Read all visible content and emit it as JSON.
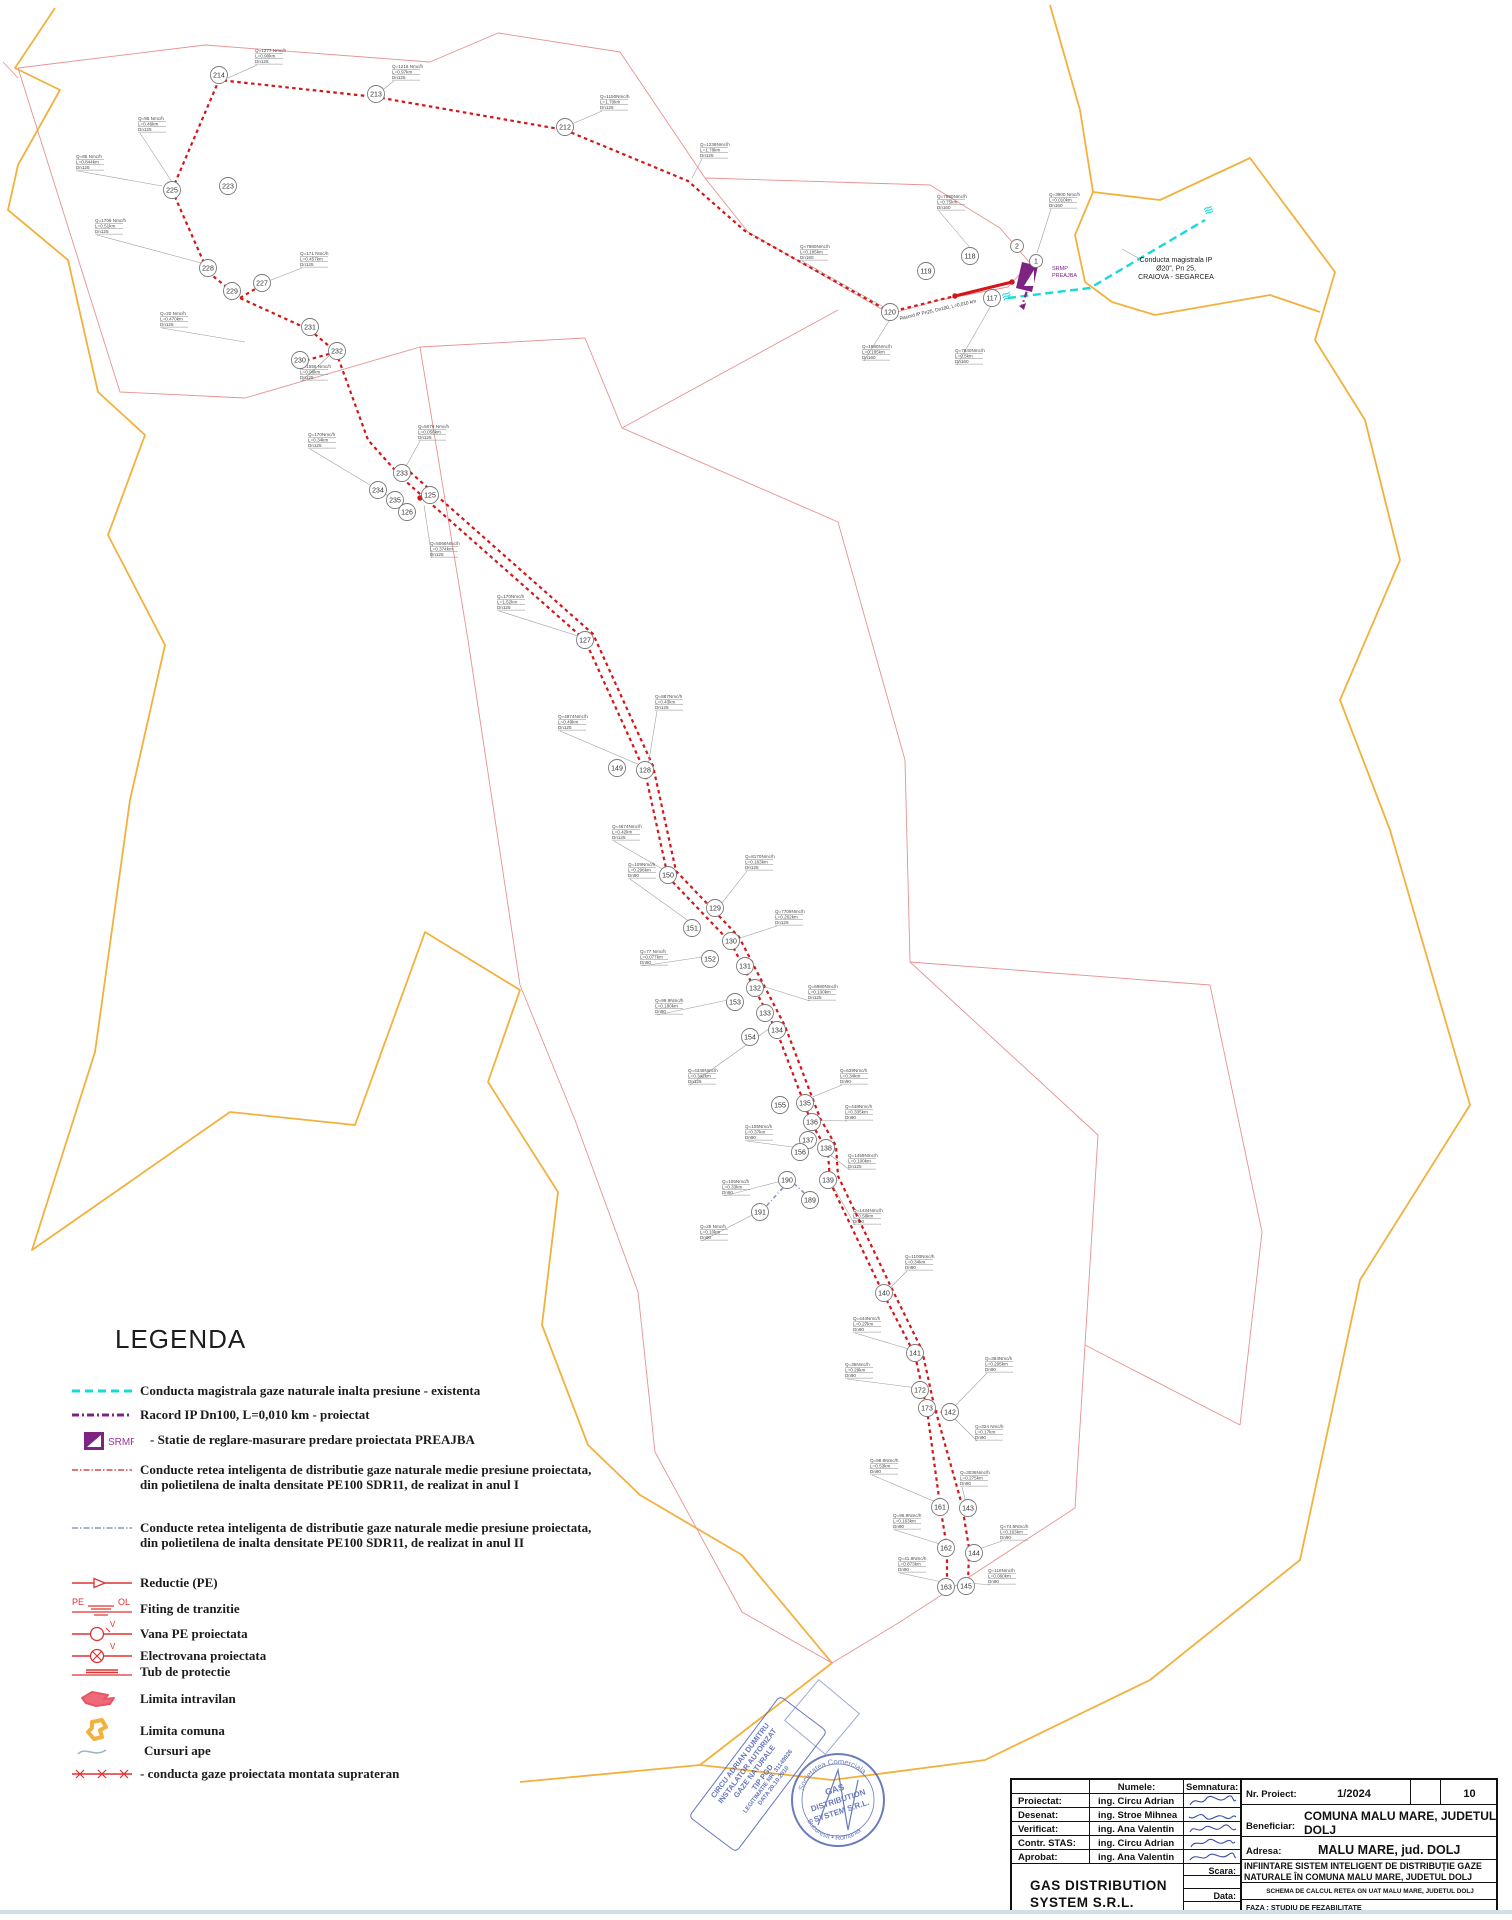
{
  "legend": {
    "title": "LEGENDA",
    "swatch_texts": {
      "srmp": "SRMP",
      "pe": "PE",
      "ol": "OL",
      "v1": "V",
      "v2": "V"
    },
    "items": [
      {
        "label": "Conducta  magistrala gaze naturale inalta presiune - existenta"
      },
      {
        "label": "Racord IP Dn100, L=0,010 km  - proiectat"
      },
      {
        "label": "- Statie de reglare-masurare predare proiectata PREAJBA"
      },
      {
        "label": "Conducte retea inteligenta de distributie gaze naturale medie presiune proiectata, din polietilena de inalta densitate PE100 SDR11, de realizat in anul I"
      },
      {
        "label": "Conducte retea inteligenta de distributie gaze naturale medie presiune proiectata, din polietilena de inalta densitate PE100 SDR11, de realizat in anul II"
      },
      {
        "label": "Reductie (PE)"
      },
      {
        "label": "Fiting de tranzitie"
      },
      {
        "label": "Vana PE proiectata"
      },
      {
        "label": "Electrovana  proiectata"
      },
      {
        "label": "Tub de protectie"
      },
      {
        "label": "Limita intravilan"
      },
      {
        "label": "Limita comuna"
      },
      {
        "label": "Cursuri ape"
      },
      {
        "label": "- conducta gaze proiectata montata suprateran"
      }
    ]
  },
  "title_block": {
    "numele_header": "Numele:",
    "semnatura_header": "Semnatura:",
    "rows": [
      {
        "label": "Proiectat:",
        "name": "ing. Circu Adrian"
      },
      {
        "label": "Desenat:",
        "name": "ing. Stroe Mihnea"
      },
      {
        "label": "Verificat:",
        "name": "ing. Ana Valentin"
      },
      {
        "label": "Contr. STAS:",
        "name": "ing. Circu Adrian"
      },
      {
        "label": "Aprobat:",
        "name": "ing. Ana Valentin"
      }
    ],
    "company": "GAS DISTRIBUTION SYSTEM S.R.L.",
    "scara_label": "Scara:",
    "data_label": "Data:",
    "nr_proiect_label": "Nr. Proiect:",
    "nr_proiect_value": "1/2024",
    "sheet_number": "10",
    "beneficiar_label": "Beneficiar:",
    "beneficiar_value": "COMUNA MALU MARE, JUDETUL DOLJ",
    "adresa_label": "Adresa:",
    "adresa_value": "MALU MARE, jud. DOLJ",
    "project_title": "INFIINTARE SISTEM INTELIGENT DE DISTRIBUŢIE  GAZE NATURALE ÎN COMUNA MALU MARE, JUDETUL DOLJ",
    "drawing_title": "SCHEMA DE CALCUL  RETEA GN  UAT MALU MARE, JUDETUL DOLJ",
    "faza": "FAZA :  STUDIU DE FEZABILITATE"
  },
  "stamps": {
    "rect": {
      "lines": [
        "CIRCU ADRIAN DUMITRU",
        "INSTALATOR AUTORIZAT",
        "GAZE NATURALE",
        "TIP PGD",
        "LEGITIMATIE NR. 31149926",
        "DATA 20.10.2010"
      ]
    },
    "round": {
      "top": "Societatea Comerciala",
      "mid1": "GAS",
      "mid2": "DISTRIBUTION",
      "mid3": "SYSTEM S.R.L.",
      "bottom": "Bucuresti • Romania"
    }
  },
  "map": {
    "boundary_comuna": [
      "55,8 15,68 60,90 18,165 8,210 68,260 98,392 145,435 108,535 165,645 130,800 95,1052 32,1250 230,1112 355,1125 425,932 520,990 488,1082 558,1192 542,1325 588,1445 640,1495 742,1555 832,1663 700,1765 520,1782",
      "1050,5 1080,110 1093,192 1160,200 1250,158 1335,272 1315,340 1365,420 1400,560 1340,700 1390,830 1470,1105 1360,1280 1300,1560 1150,1680 985,1760 832,1780 700,1765",
      "1093,192 1075,235 1085,282 1112,302 1155,315 1270,295 1320,312"
    ],
    "boundary_intravilan": [
      "18,68 205,45 430,62 498,33 620,52 705,178 748,232 890,314",
      "890,314 940,300 1008,287 1030,263 1000,228 930,185 705,178",
      "18,68 120,392 245,398 420,347 585,338",
      "622,428 838,310",
      "585,338 622,428 838,522 905,760 910,962 1098,1135 1085,1345 1075,1508 900,1622 832,1663 742,1612 655,1452 638,1292 575,1120 520,985 468,640 420,347",
      "910,962 1210,985 1262,1232 1240,1425 1085,1345",
      "3,62 18,78"
    ],
    "pipe_year1": [
      "172,190 219,80 376,97 565,130 688,181 745,231 890,312 955,296",
      "172,190 208,272 240,298 310,330 336,352 368,440 402,478",
      "240,298 262,285",
      "336,352 300,362",
      "402,478 585,640 645,772 668,877 731,943 777,1032 812,1124 828,1152 830,1182 884,1295 915,1355 927,1410 940,1505 947,1548 947,1587",
      "410,472 593,634 653,766 676,871 739,937 785,1026 820,1118 836,1146 838,1176 892,1289 922,1350 934,1405 962,1505 969,1548 968,1586",
      "927,1410 950,1413"
    ],
    "pipe_year1_solid": [
      "955,296 1012,282"
    ],
    "pipe_year2": [
      "760,1213 790,1180 812,1200"
    ],
    "pipe_main_existing": "1008,298 1090,288 1205,220",
    "pipe_racord": "1035,266 1022,306",
    "breaks": [
      [
        1205,
        216,
        -20
      ],
      [
        1003,
        302,
        -20
      ]
    ],
    "junctions": [
      [
        172,
        190
      ],
      [
        402,
        478
      ],
      [
        648,
        772
      ],
      [
        731,
        943
      ],
      [
        812,
        1124
      ],
      [
        830,
        1182
      ],
      [
        884,
        1295
      ],
      [
        927,
        1410
      ],
      [
        955,
        296
      ],
      [
        1012,
        282
      ],
      [
        420,
        498
      ]
    ],
    "srmp": {
      "shape": "1022,262 1038,266 1032,292 1016,288",
      "tri": "1024,286 1034,270 1034,286"
    },
    "nodes": [
      {
        "n": "214",
        "x": 219,
        "y": 75
      },
      {
        "n": "213",
        "x": 376,
        "y": 94
      },
      {
        "n": "212",
        "x": 565,
        "y": 127
      },
      {
        "n": "225",
        "x": 172,
        "y": 190
      },
      {
        "n": "223",
        "x": 228,
        "y": 186
      },
      {
        "n": "228",
        "x": 208,
        "y": 268
      },
      {
        "n": "229",
        "x": 232,
        "y": 291
      },
      {
        "n": "227",
        "x": 262,
        "y": 283
      },
      {
        "n": "231",
        "x": 310,
        "y": 327
      },
      {
        "n": "230",
        "x": 300,
        "y": 360
      },
      {
        "n": "232",
        "x": 337,
        "y": 351
      },
      {
        "n": "119",
        "x": 926,
        "y": 271
      },
      {
        "n": "118",
        "x": 970,
        "y": 256
      },
      {
        "n": "117",
        "x": 992,
        "y": 298
      },
      {
        "n": "120",
        "x": 890,
        "y": 312
      },
      {
        "n": "2",
        "x": 1017,
        "y": 246,
        "r": 6.5
      },
      {
        "n": "1",
        "x": 1036,
        "y": 261,
        "r": 6.5
      },
      {
        "n": "233",
        "x": 402,
        "y": 473
      },
      {
        "n": "234",
        "x": 378,
        "y": 490
      },
      {
        "n": "235",
        "x": 395,
        "y": 500
      },
      {
        "n": "125",
        "x": 430,
        "y": 495
      },
      {
        "n": "126",
        "x": 407,
        "y": 512
      },
      {
        "n": "127",
        "x": 585,
        "y": 640
      },
      {
        "n": "149",
        "x": 617,
        "y": 768
      },
      {
        "n": "128",
        "x": 645,
        "y": 770
      },
      {
        "n": "150",
        "x": 668,
        "y": 875
      },
      {
        "n": "129",
        "x": 715,
        "y": 908
      },
      {
        "n": "151",
        "x": 692,
        "y": 928
      },
      {
        "n": "130",
        "x": 731,
        "y": 941
      },
      {
        "n": "152",
        "x": 710,
        "y": 959
      },
      {
        "n": "131",
        "x": 745,
        "y": 966
      },
      {
        "n": "132",
        "x": 755,
        "y": 988
      },
      {
        "n": "153",
        "x": 735,
        "y": 1002
      },
      {
        "n": "133",
        "x": 765,
        "y": 1013
      },
      {
        "n": "134",
        "x": 777,
        "y": 1030
      },
      {
        "n": "154",
        "x": 750,
        "y": 1037
      },
      {
        "n": "155",
        "x": 780,
        "y": 1105
      },
      {
        "n": "135",
        "x": 805,
        "y": 1103
      },
      {
        "n": "136",
        "x": 812,
        "y": 1122
      },
      {
        "n": "137",
        "x": 808,
        "y": 1140
      },
      {
        "n": "156",
        "x": 800,
        "y": 1152
      },
      {
        "n": "138",
        "x": 826,
        "y": 1148
      },
      {
        "n": "190",
        "x": 787,
        "y": 1180
      },
      {
        "n": "139",
        "x": 828,
        "y": 1180
      },
      {
        "n": "189",
        "x": 810,
        "y": 1200
      },
      {
        "n": "191",
        "x": 760,
        "y": 1212
      },
      {
        "n": "140",
        "x": 884,
        "y": 1293
      },
      {
        "n": "141",
        "x": 915,
        "y": 1353
      },
      {
        "n": "172",
        "x": 920,
        "y": 1390
      },
      {
        "n": "173",
        "x": 927,
        "y": 1408
      },
      {
        "n": "142",
        "x": 950,
        "y": 1412
      },
      {
        "n": "161",
        "x": 940,
        "y": 1507
      },
      {
        "n": "143",
        "x": 968,
        "y": 1508
      },
      {
        "n": "162",
        "x": 946,
        "y": 1548
      },
      {
        "n": "144",
        "x": 974,
        "y": 1553
      },
      {
        "n": "163",
        "x": 946,
        "y": 1587
      },
      {
        "n": "145",
        "x": 966,
        "y": 1586
      }
    ],
    "labels": [
      {
        "x": 937,
        "y": 198,
        "lx": 972,
        "ly": 250,
        "l": [
          "Q=7680Nmc/h",
          "L=0.75km",
          "Dn160"
        ]
      },
      {
        "x": 1049,
        "y": 196,
        "lx": 1037,
        "ly": 253,
        "l": [
          "Q=3900 Nmc/h",
          "L=0.010km",
          "Dn160"
        ]
      },
      {
        "x": 255,
        "y": 52,
        "lx": 228,
        "ly": 78,
        "l": [
          "Q=1277 Nmc/h",
          "L=0.90km",
          "Dn125"
        ]
      },
      {
        "x": 392,
        "y": 68,
        "lx": 380,
        "ly": 92,
        "l": [
          "Q=1216 Nmc/h",
          "L=0.97km",
          "Dn125"
        ]
      },
      {
        "x": 600,
        "y": 98,
        "lx": 572,
        "ly": 124,
        "l": [
          "Q=1150Nmc/h",
          "L=1.70km",
          "Dn125"
        ]
      },
      {
        "x": 700,
        "y": 146,
        "lx": 692,
        "ly": 178,
        "l": [
          "Q=1236Nmc/h",
          "L=1.78km",
          "Dn125"
        ]
      },
      {
        "x": 76,
        "y": 158,
        "lx": 162,
        "ly": 186,
        "l": [
          "Q=85 Nmc/h",
          "L=0.844km",
          "Dn125"
        ]
      },
      {
        "x": 138,
        "y": 120,
        "lx": 172,
        "ly": 182,
        "l": [
          "Q=95 Nmc/h",
          "L=0.46km",
          "Dn125"
        ]
      },
      {
        "x": 95,
        "y": 222,
        "lx": 205,
        "ly": 264,
        "l": [
          "Q=1706 Nmc/h",
          "L=0.51km",
          "Dn125"
        ]
      },
      {
        "x": 300,
        "y": 255,
        "lx": 266,
        "ly": 282,
        "l": [
          "Q=171 Nmc/h",
          "L=0.457km",
          "Dn125"
        ]
      },
      {
        "x": 160,
        "y": 315,
        "lx": 245,
        "ly": 342,
        "l": [
          "Q=20 Nmc/h",
          "L=0.470km",
          "Dn125"
        ]
      },
      {
        "x": 300,
        "y": 368,
        "lx": 332,
        "ly": 353,
        "l": [
          "Q=1556 Nmc/h",
          "L=0.96km",
          "Dn125"
        ]
      },
      {
        "x": 800,
        "y": 248,
        "lx": 882,
        "ly": 306,
        "l": [
          "Q=7680Nmc/h",
          "L=0.185km",
          "Dn160"
        ]
      },
      {
        "x": 862,
        "y": 348,
        "lx": 892,
        "ly": 316,
        "l": [
          "Q=1680Nmc/h",
          "L=0.185km",
          "Dn160"
        ]
      },
      {
        "x": 955,
        "y": 352,
        "lx": 993,
        "ly": 302,
        "l": [
          "Q=7640Nmc/h",
          "L=0.5km",
          "Dn160"
        ]
      },
      {
        "x": 418,
        "y": 428,
        "lx": 404,
        "ly": 470,
        "l": [
          "Q=5076 Nmc/h",
          "L=0.056km",
          "Dn125"
        ]
      },
      {
        "x": 308,
        "y": 436,
        "lx": 390,
        "ly": 497,
        "l": [
          "Q=170Nmc/h",
          "L=0.34km",
          "Dn125"
        ]
      },
      {
        "x": 430,
        "y": 545,
        "lx": 424,
        "ly": 505,
        "l": [
          "Q=5066Nmc/h",
          "L=0.374km",
          "Dn125"
        ]
      },
      {
        "x": 497,
        "y": 598,
        "lx": 578,
        "ly": 636,
        "l": [
          "Q=170Nmc/h",
          "L=1.52km",
          "Dn125"
        ]
      },
      {
        "x": 558,
        "y": 718,
        "lx": 640,
        "ly": 765,
        "l": [
          "Q=4874Nmc/h",
          "L=0.49km",
          "Dn125"
        ]
      },
      {
        "x": 655,
        "y": 698,
        "lx": 648,
        "ly": 766,
        "l": [
          "Q=887Nmc/h",
          "L=0.43km",
          "Dn125"
        ]
      },
      {
        "x": 612,
        "y": 828,
        "lx": 664,
        "ly": 870,
        "l": [
          "Q=4674Nmc/h",
          "L=0.42km",
          "Dn125"
        ]
      },
      {
        "x": 745,
        "y": 858,
        "lx": 722,
        "ly": 903,
        "l": [
          "Q=8170Nmc/h",
          "L=0.163km",
          "Dn125"
        ]
      },
      {
        "x": 628,
        "y": 866,
        "lx": 690,
        "ly": 922,
        "l": [
          "Q=109Nmc/h",
          "L=0.296km",
          "Dn90"
        ]
      },
      {
        "x": 775,
        "y": 913,
        "lx": 740,
        "ly": 938,
        "l": [
          "Q=7709Nmc/h",
          "L=0.262km",
          "Dn125"
        ]
      },
      {
        "x": 640,
        "y": 953,
        "lx": 702,
        "ly": 957,
        "l": [
          "Q=77 Nmc/h",
          "L=0.077km",
          "Dn90"
        ]
      },
      {
        "x": 808,
        "y": 988,
        "lx": 762,
        "ly": 986,
        "l": [
          "Q=6980Nmc/h",
          "L=0.100km",
          "Dn125"
        ]
      },
      {
        "x": 655,
        "y": 1002,
        "lx": 728,
        "ly": 1000,
        "l": [
          "Q=99.9Nmc/h",
          "L=0.180km",
          "Dn90"
        ]
      },
      {
        "x": 688,
        "y": 1072,
        "lx": 770,
        "ly": 1028,
        "l": [
          "Q=4349Nmc/h",
          "L=0.342km",
          "Dn125"
        ]
      },
      {
        "x": 840,
        "y": 1072,
        "lx": 810,
        "ly": 1098,
        "l": [
          "Q=639Nmc/h",
          "L=0.34km",
          "Dn90"
        ]
      },
      {
        "x": 845,
        "y": 1108,
        "lx": 818,
        "ly": 1120,
        "l": [
          "Q=448Nmc/h",
          "L=0.335km",
          "Dn90"
        ]
      },
      {
        "x": 745,
        "y": 1128,
        "lx": 800,
        "ly": 1148,
        "l": [
          "Q=105Nmc/h",
          "L=0.37km",
          "Dn90"
        ]
      },
      {
        "x": 848,
        "y": 1157,
        "lx": 818,
        "ly": 1146,
        "l": [
          "Q=1459Nmc/h",
          "L=0.100km",
          "Dn125"
        ]
      },
      {
        "x": 722,
        "y": 1183,
        "lx": 785,
        "ly": 1180,
        "l": [
          "Q=105Nmc/h",
          "L=0.33km",
          "Dn90"
        ]
      },
      {
        "x": 700,
        "y": 1228,
        "lx": 758,
        "ly": 1212,
        "l": [
          "Q=25 Nmc/h",
          "L=0.10km",
          "Dn90"
        ]
      },
      {
        "x": 853,
        "y": 1212,
        "lx": 832,
        "ly": 1184,
        "l": [
          "Q=1434Nmc/h",
          "L=0.58km",
          "Dn90"
        ]
      },
      {
        "x": 905,
        "y": 1258,
        "lx": 888,
        "ly": 1290,
        "l": [
          "Q=1100Nmc/h",
          "L=0.34km",
          "Dn90"
        ]
      },
      {
        "x": 853,
        "y": 1320,
        "lx": 912,
        "ly": 1350,
        "l": [
          "Q=444Nmc/h",
          "L=0.27km",
          "Dn90"
        ]
      },
      {
        "x": 845,
        "y": 1366,
        "lx": 917,
        "ly": 1388,
        "l": [
          "Q=35Nmc/h",
          "L=0.29km",
          "Dn90"
        ]
      },
      {
        "x": 985,
        "y": 1360,
        "lx": 953,
        "ly": 1408,
        "l": [
          "Q=384Nmc/h",
          "L=0.295km",
          "Dn90"
        ]
      },
      {
        "x": 975,
        "y": 1428,
        "lx": 952,
        "ly": 1416,
        "l": [
          "Q=324 Nmc/h",
          "L=0.17km",
          "Dn90"
        ]
      },
      {
        "x": 870,
        "y": 1462,
        "lx": 938,
        "ly": 1503,
        "l": [
          "Q=98.9Nmc/h",
          "L=0.53km",
          "Dn90"
        ]
      },
      {
        "x": 960,
        "y": 1474,
        "lx": 966,
        "ly": 1503,
        "l": [
          "Q=3036Nmc/h",
          "L=0.275km",
          "Dn90"
        ]
      },
      {
        "x": 893,
        "y": 1517,
        "lx": 943,
        "ly": 1545,
        "l": [
          "Q=96.9Nmc/h",
          "L=0.163km",
          "Dn90"
        ]
      },
      {
        "x": 1000,
        "y": 1528,
        "lx": 976,
        "ly": 1550,
        "l": [
          "Q=74.8Nmc/h",
          "L=0.163km",
          "Dn90"
        ]
      },
      {
        "x": 898,
        "y": 1560,
        "lx": 942,
        "ly": 1582,
        "l": [
          "Q=41.8Nmc/h",
          "L=0.873km",
          "Dn90"
        ]
      },
      {
        "x": 988,
        "y": 1572,
        "lx": 970,
        "ly": 1583,
        "l": [
          "Q=118Nmc/h",
          "L=0.060km",
          "Dn90"
        ]
      }
    ],
    "texts": [
      {
        "x": 1176,
        "y": 262,
        "size": 7,
        "color": "#222",
        "anchor": "middle",
        "lh": 8.5,
        "lines": [
          "Conducta magistrala IP",
          "Ø20\", Pn 25,",
          "CRAIOVA - SEGARCEA"
        ]
      },
      {
        "x": 1052,
        "y": 270,
        "size": 5.5,
        "color": "#7d2483",
        "anchor": "start",
        "lh": 7,
        "lines": [
          "SRMP",
          "PREAJBA"
        ]
      },
      {
        "x": 900,
        "y": 320,
        "size": 4.8,
        "color": "#333",
        "anchor": "start",
        "rotate": -13,
        "lh": 6,
        "lines": [
          "Racord IP Pn25, Dn100, L=0,010 km"
        ]
      }
    ],
    "text_leader": "1140,259 1122,249"
  }
}
